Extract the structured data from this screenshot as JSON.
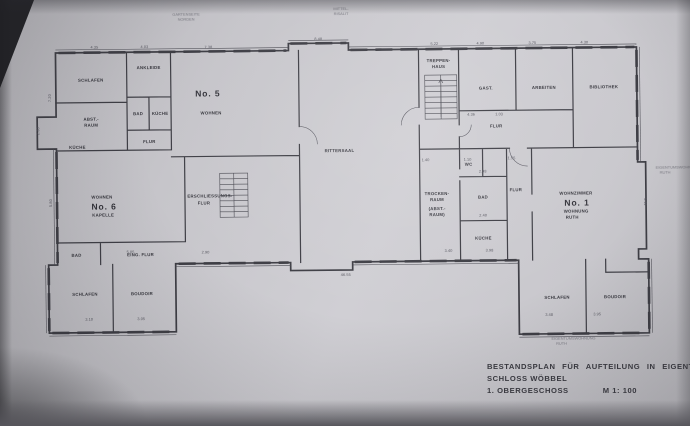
{
  "title_block": {
    "line1": "BESTANDSPLAN FÜR AUFTEILUNG IN EIGENTUMSWOHNUNGEN",
    "line2": "SCHLOSS WÖBBEL",
    "line3": "1. OBERGESCHOSS",
    "scale": "M 1: 100"
  },
  "apartments": {
    "no5": {
      "number": "No. 5",
      "label": "WOHNEN"
    },
    "no6": {
      "label": "WOHNEN",
      "number": "No. 6",
      "name": "KAPELLE"
    },
    "no1": {
      "label": "WOHNZIMMER",
      "number": "No. 1",
      "line2": "WOHNUNG",
      "line3": "RUTH"
    }
  },
  "rooms": {
    "schlafen_nw": "SCHLAFEN",
    "ankleide": "ANKLEIDE",
    "abst_1": "ABST.-",
    "abst_2": "RAUM",
    "bad_nw": "BAD",
    "kueche_nw": "KÜCHE",
    "flur_nw": "FLUR",
    "kueche_w": "KÜCHE",
    "rittersaal": "RITTERSAAL",
    "treppenhaus_1": "TREPPEN-",
    "treppenhaus_2": "HAUS",
    "gast": "GAST.",
    "arbeiten": "ARBEITEN",
    "bibliothek": "BIBLIOTHEK",
    "flur_ne": "FLUR",
    "trocken_1": "TROCKEN-",
    "trocken_2": "RAUM",
    "trocken_3": "(ABST.-",
    "trocken_4": "RAUM)",
    "wc": "WC",
    "bad_e": "BAD",
    "flur_e": "FLUR",
    "kueche_e": "KÜCHE",
    "erschliessung_1": "ERSCHLIESSUNGS-",
    "erschliessung_2": "FLUR",
    "eing_flur": "EING. FLUR",
    "bad_sw": "BAD",
    "schlafen_sw": "SCHLAFEN",
    "boudoir_sw": "BOUDOIR",
    "schlafen_se": "SCHLAFEN",
    "boudoir_se": "BOUDOIR"
  },
  "annotations": {
    "top_left_1": "GARTENSEITE",
    "top_left_2": "NORDEN",
    "top_center_1": "MITTEL-",
    "top_center_2": "RISALIT",
    "right_1": "EIGENTUMSWOHNUNG",
    "right_2": "RUTH",
    "bottom_1": "EIGENTUMSWOHNUNG",
    "bottom_2": "RUTH"
  },
  "dimensions": [
    {
      "x": 96,
      "y": 46,
      "t": "4.35"
    },
    {
      "x": 146,
      "y": 46,
      "t": "4.03"
    },
    {
      "x": 210,
      "y": 47,
      "t": "7.38"
    },
    {
      "x": 320,
      "y": 40,
      "t": "8.48"
    },
    {
      "x": 436,
      "y": 46,
      "t": "5.22"
    },
    {
      "x": 482,
      "y": 46,
      "t": "4.90"
    },
    {
      "x": 534,
      "y": 46,
      "t": "3.75"
    },
    {
      "x": 586,
      "y": 46,
      "t": "4.30"
    },
    {
      "x": 52,
      "y": 95,
      "t": "7.20",
      "r": -90
    },
    {
      "x": 52,
      "y": 200,
      "t": "5.80",
      "r": -90
    },
    {
      "x": 40,
      "y": 128,
      "t": "2.30",
      "r": -90
    },
    {
      "x": 644,
      "y": 205,
      "t": "5.11",
      "r": 90
    },
    {
      "x": 345,
      "y": 276,
      "t": "46.55"
    },
    {
      "x": 472,
      "y": 117,
      "t": "4.36"
    },
    {
      "x": 500,
      "y": 117,
      "t": "1.03"
    },
    {
      "x": 426,
      "y": 162,
      "t": "1.40"
    },
    {
      "x": 468,
      "y": 162,
      "t": "1.10"
    },
    {
      "x": 512,
      "y": 161,
      "t": "1.55"
    },
    {
      "x": 483,
      "y": 174,
      "t": "2.98"
    },
    {
      "x": 483,
      "y": 218,
      "t": "2.40"
    },
    {
      "x": 448,
      "y": 253,
      "t": "3.40"
    },
    {
      "x": 489,
      "y": 253,
      "t": "3.98"
    },
    {
      "x": 130,
      "y": 251,
      "t": "5.05"
    },
    {
      "x": 205,
      "y": 252,
      "t": "2.90"
    },
    {
      "x": 88,
      "y": 318,
      "t": "3.10"
    },
    {
      "x": 140,
      "y": 318,
      "t": "3.05"
    },
    {
      "x": 548,
      "y": 318,
      "t": "3.48"
    },
    {
      "x": 596,
      "y": 318,
      "t": "3.95"
    }
  ]
}
